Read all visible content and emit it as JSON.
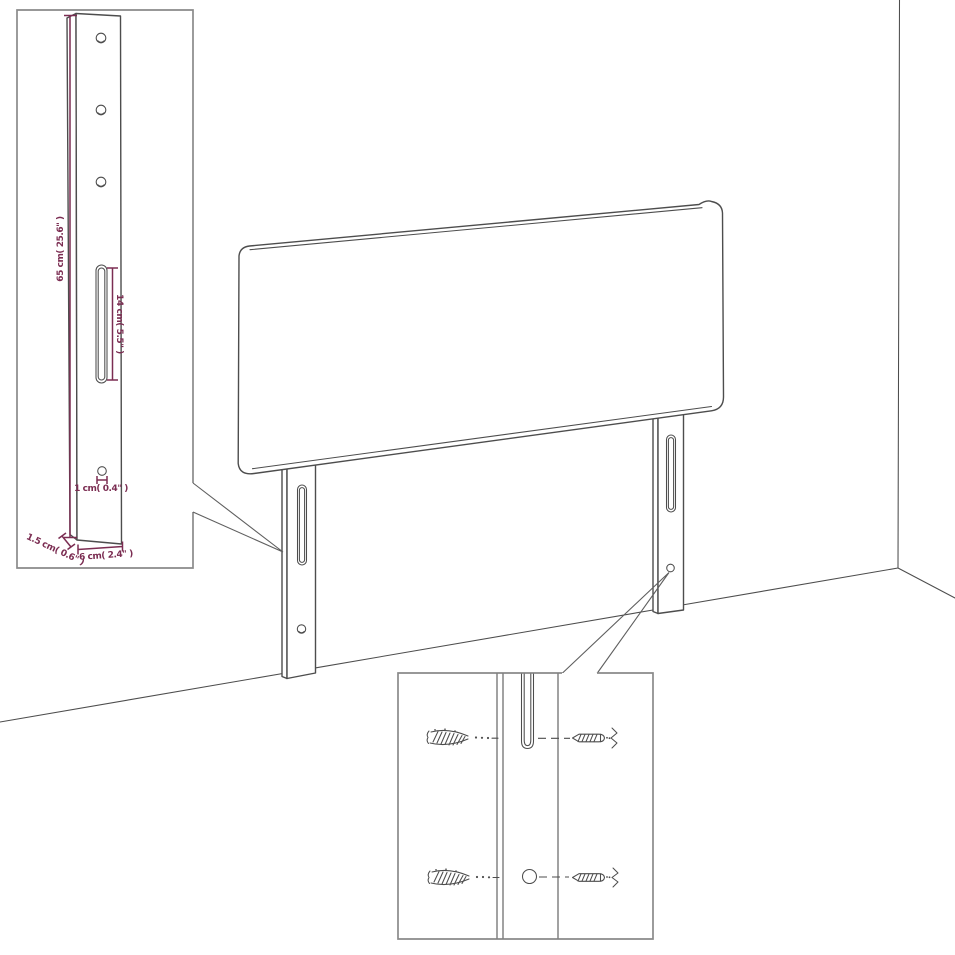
{
  "image": {
    "description": "Black-and-white line-art assembly diagram of a headboard with two slotted mounting legs standing in a room corner, with a dimensioned leg inset and a wall-plug/screw mounting detail inset",
    "background": "#ffffff"
  },
  "colors": {
    "line_art": "#4d4d4d",
    "inset_border": "#8a8a8a",
    "dimension_text": "#7b2d52"
  },
  "leg_dimension_inset": {
    "labels": {
      "height": "65 cm( 25.6\" )",
      "slot_length": "14 cm( 5.5\" )",
      "hole_diameter": "1 cm( 0.4\" )",
      "thickness": "1.5 cm( 0.6\" )",
      "width": "6 cm( 2.4\" )"
    }
  },
  "mounting_detail_inset": {
    "hardware": {
      "wall_plug": "wall-plug-anchor-drawing",
      "screw": "wood-screw-drawing"
    },
    "rows": 2
  }
}
